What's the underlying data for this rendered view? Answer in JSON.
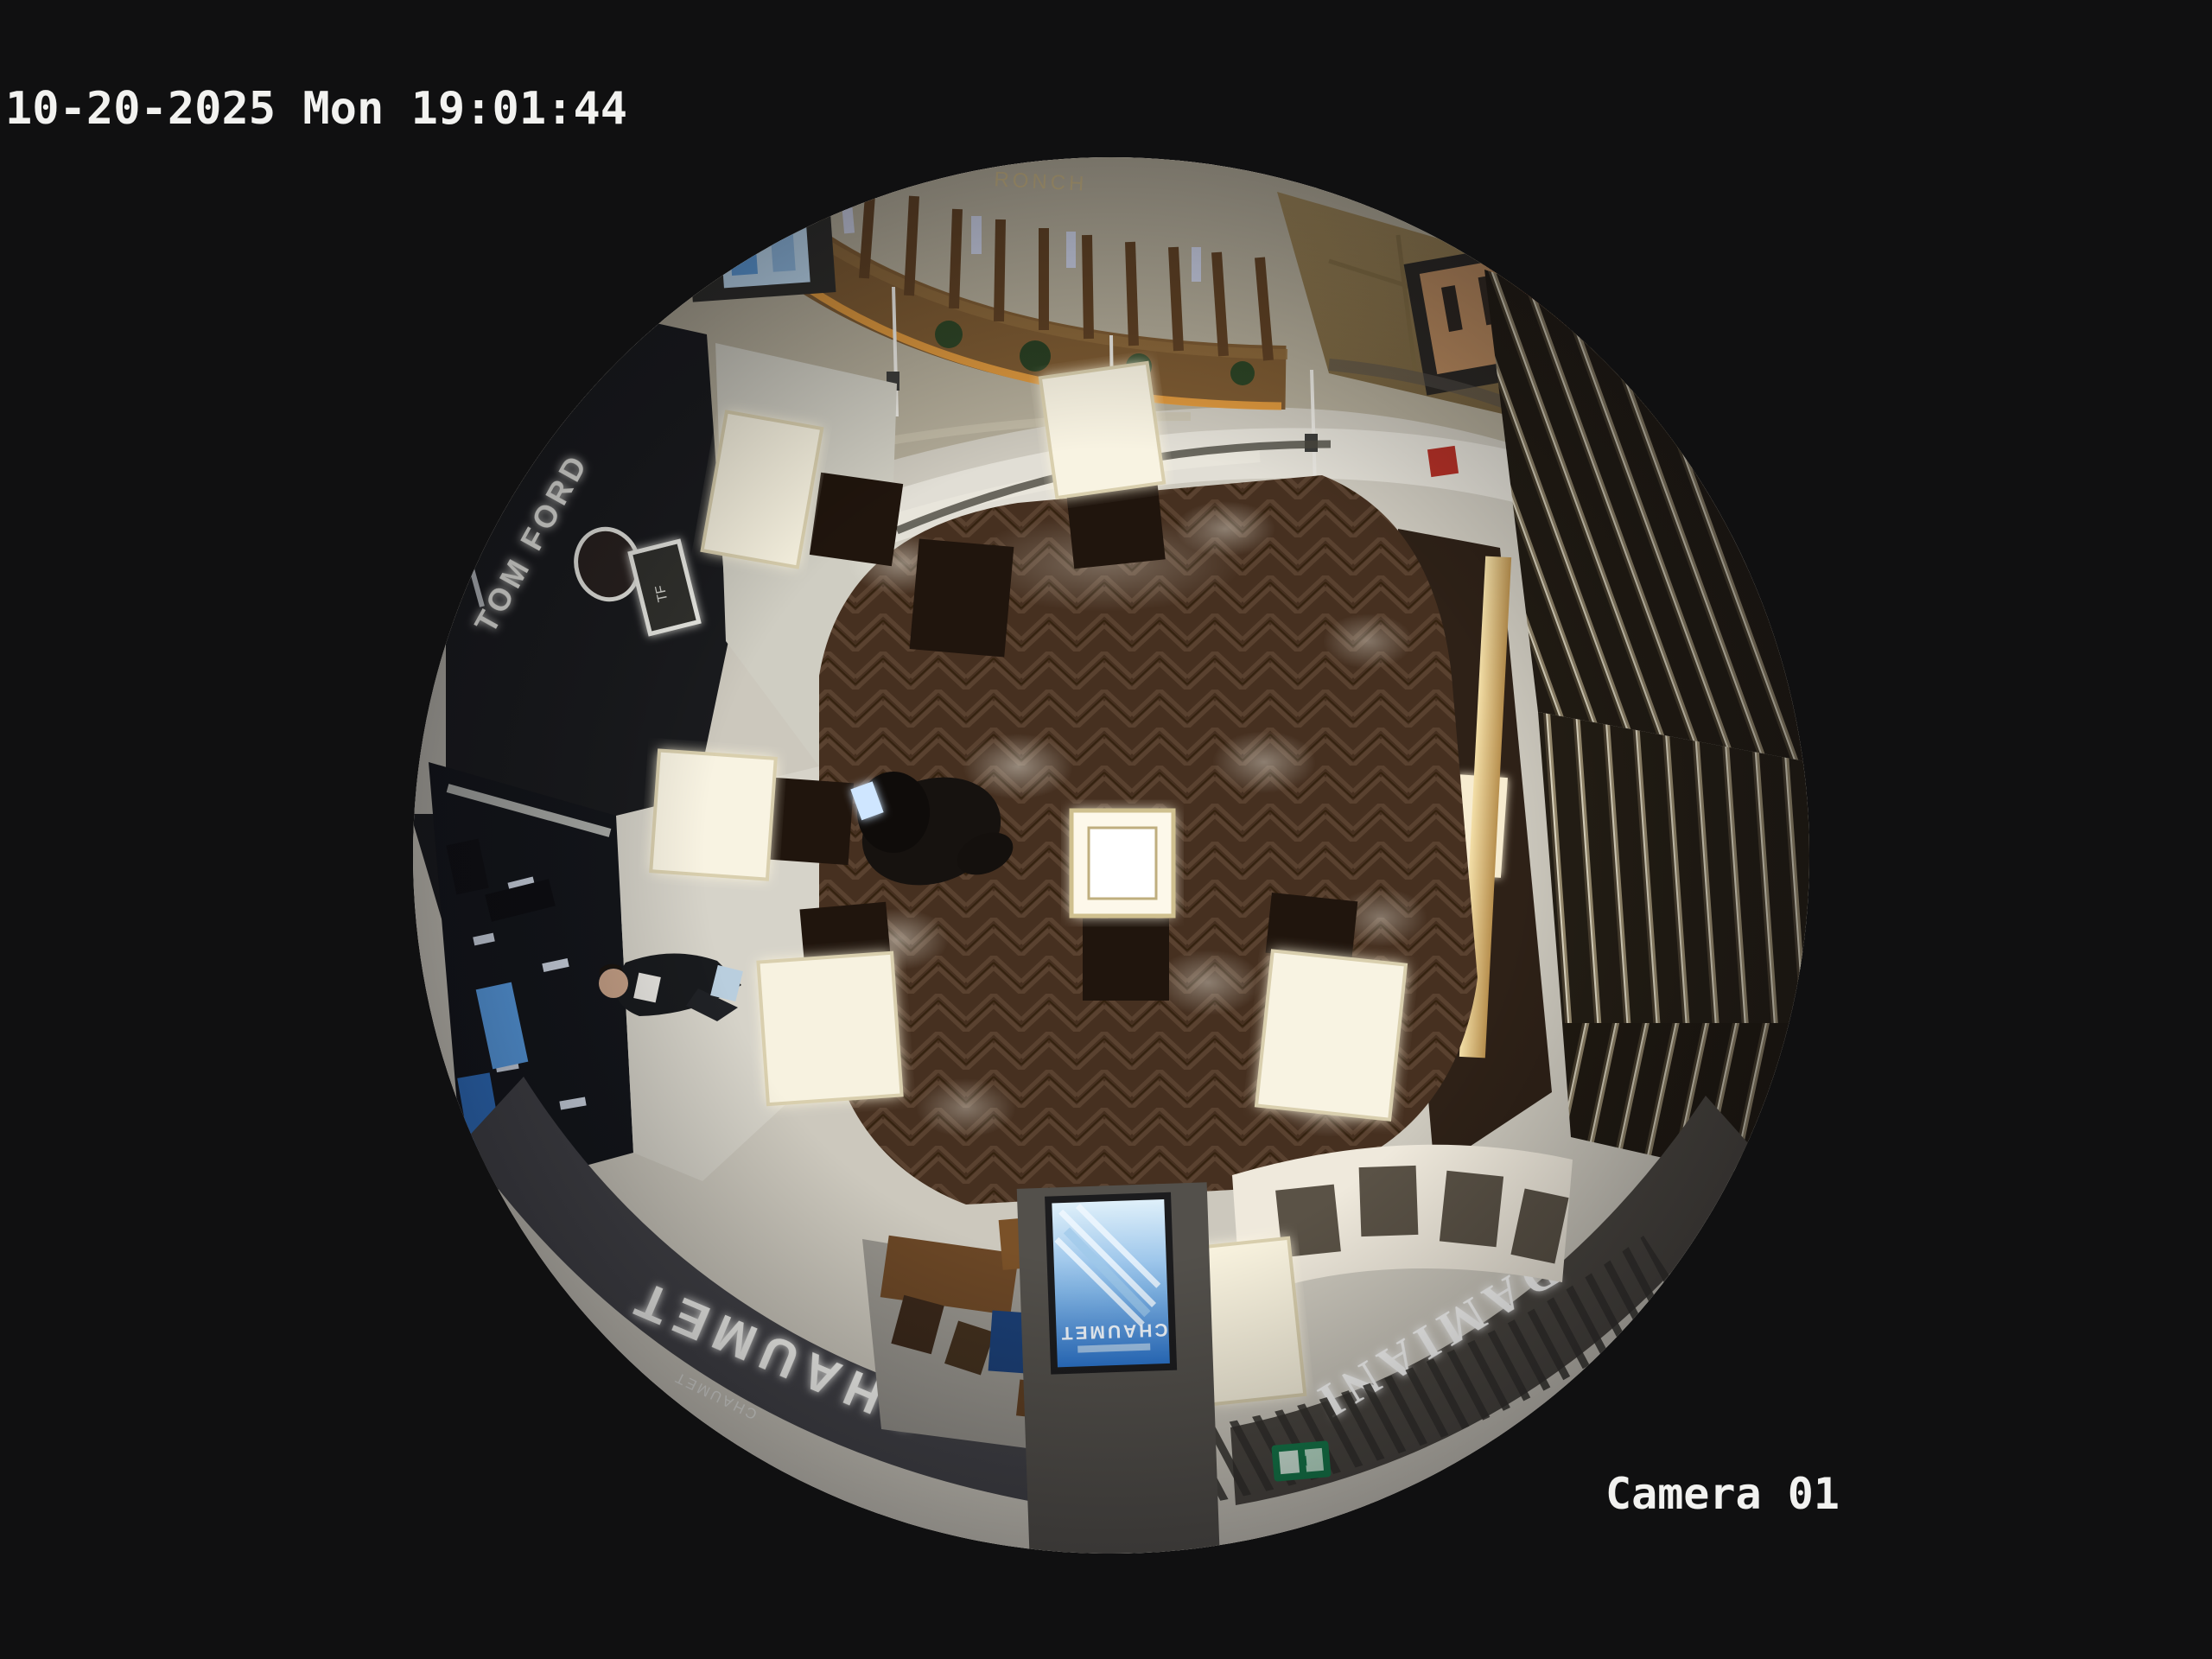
{
  "osd": {
    "timestamp": "10-20-2025 Mon 19:01:44",
    "camera_label": "Camera 01",
    "text_color": "#f2f2f0"
  },
  "scene": {
    "signs": {
      "tom_ford": "TOM FORD",
      "tf_monogram": "TF",
      "chaumet_fascia": "CHAUMET",
      "chaumet_fascia_small": "CHAUMET",
      "chaumet_ad_screen": "CHAUMET",
      "damiani_fascia": "DAMIANI",
      "gold_wall_sign": "RONCH"
    },
    "colors": {
      "background_black": "#101011",
      "outer_stone_ring": "#c9c5ba",
      "corridor_marble": "#b2ab98",
      "herringbone_wood": "#463020",
      "fascia_dark": "#424247",
      "display_case_glow": "#f8f2de",
      "ad_screen_blue": "#2b72c8",
      "exit_sign_green": "#157a4a",
      "amber_light_strip": "#e09a3e"
    }
  }
}
